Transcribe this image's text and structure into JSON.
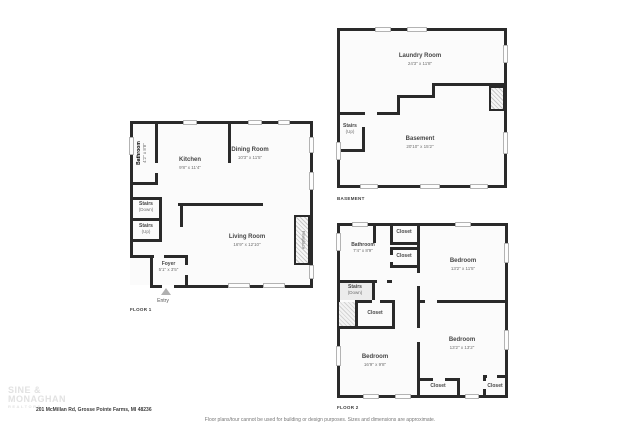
{
  "meta": {
    "address": "201 McMillan Rd, Grosse Pointe Farms, MI 48236",
    "disclaimer": "Floor plans/tour cannot be used for building or design purposes. Sizes and dimensions are approximate.",
    "watermark": {
      "line1": "SINE &",
      "line2": "MONAGHAN",
      "line3": "REALTORS"
    },
    "wall_color": "#2a2a2a",
    "room_fill_color": "#fbfbfb"
  },
  "floor1": {
    "label": "FLOOR 1",
    "bathroom": {
      "name": "Bathroom",
      "dims": "4'2\" x 8'8\""
    },
    "kitchen": {
      "name": "Kitchen",
      "dims": "9'8\" x 11'4\""
    },
    "dining_room": {
      "name": "Dining Room",
      "dims": "10'3\" x 11'5\""
    },
    "living_room": {
      "name": "Living Room",
      "dims": "16'9\" x 12'10\""
    },
    "stairs_down": {
      "name": "Stairs",
      "dims": "(Down)"
    },
    "stairs_up": {
      "name": "Stairs",
      "dims": "(Up)"
    },
    "foyer": {
      "name": "Foyer",
      "dims": "5'1\" x 3'5\""
    },
    "fireplace": {
      "name": "Fireplace"
    },
    "entry": {
      "name": "Entry"
    }
  },
  "basement": {
    "label": "BASEMENT",
    "laundry_room": {
      "name": "Laundry Room",
      "dims": "24'3\" x 11'8\""
    },
    "basement_room": {
      "name": "Basement",
      "dims": "20'10\" x 15'2\""
    },
    "stairs_up": {
      "name": "Stairs",
      "dims": "(Up)"
    }
  },
  "floor2": {
    "label": "FLOOR 2",
    "bathroom": {
      "name": "Bathroom",
      "dims": "7'4\" x 8'9\""
    },
    "bedroom_top": {
      "name": "Bedroom",
      "dims": "13'2\" x 11'5\""
    },
    "bedroom_left": {
      "name": "Bedroom",
      "dims": "16'9\" x 9'8\""
    },
    "bedroom_right": {
      "name": "Bedroom",
      "dims": "13'2\" x 13'2\""
    },
    "stairs_down": {
      "name": "Stairs",
      "dims": "(Down)"
    },
    "closet_top": {
      "name": "Closet"
    },
    "closet_upper": {
      "name": "Closet"
    },
    "closet_mid": {
      "name": "Closet"
    },
    "closet_bottom": {
      "name": "Closet"
    },
    "closet_corner": {
      "name": "Closet"
    }
  }
}
